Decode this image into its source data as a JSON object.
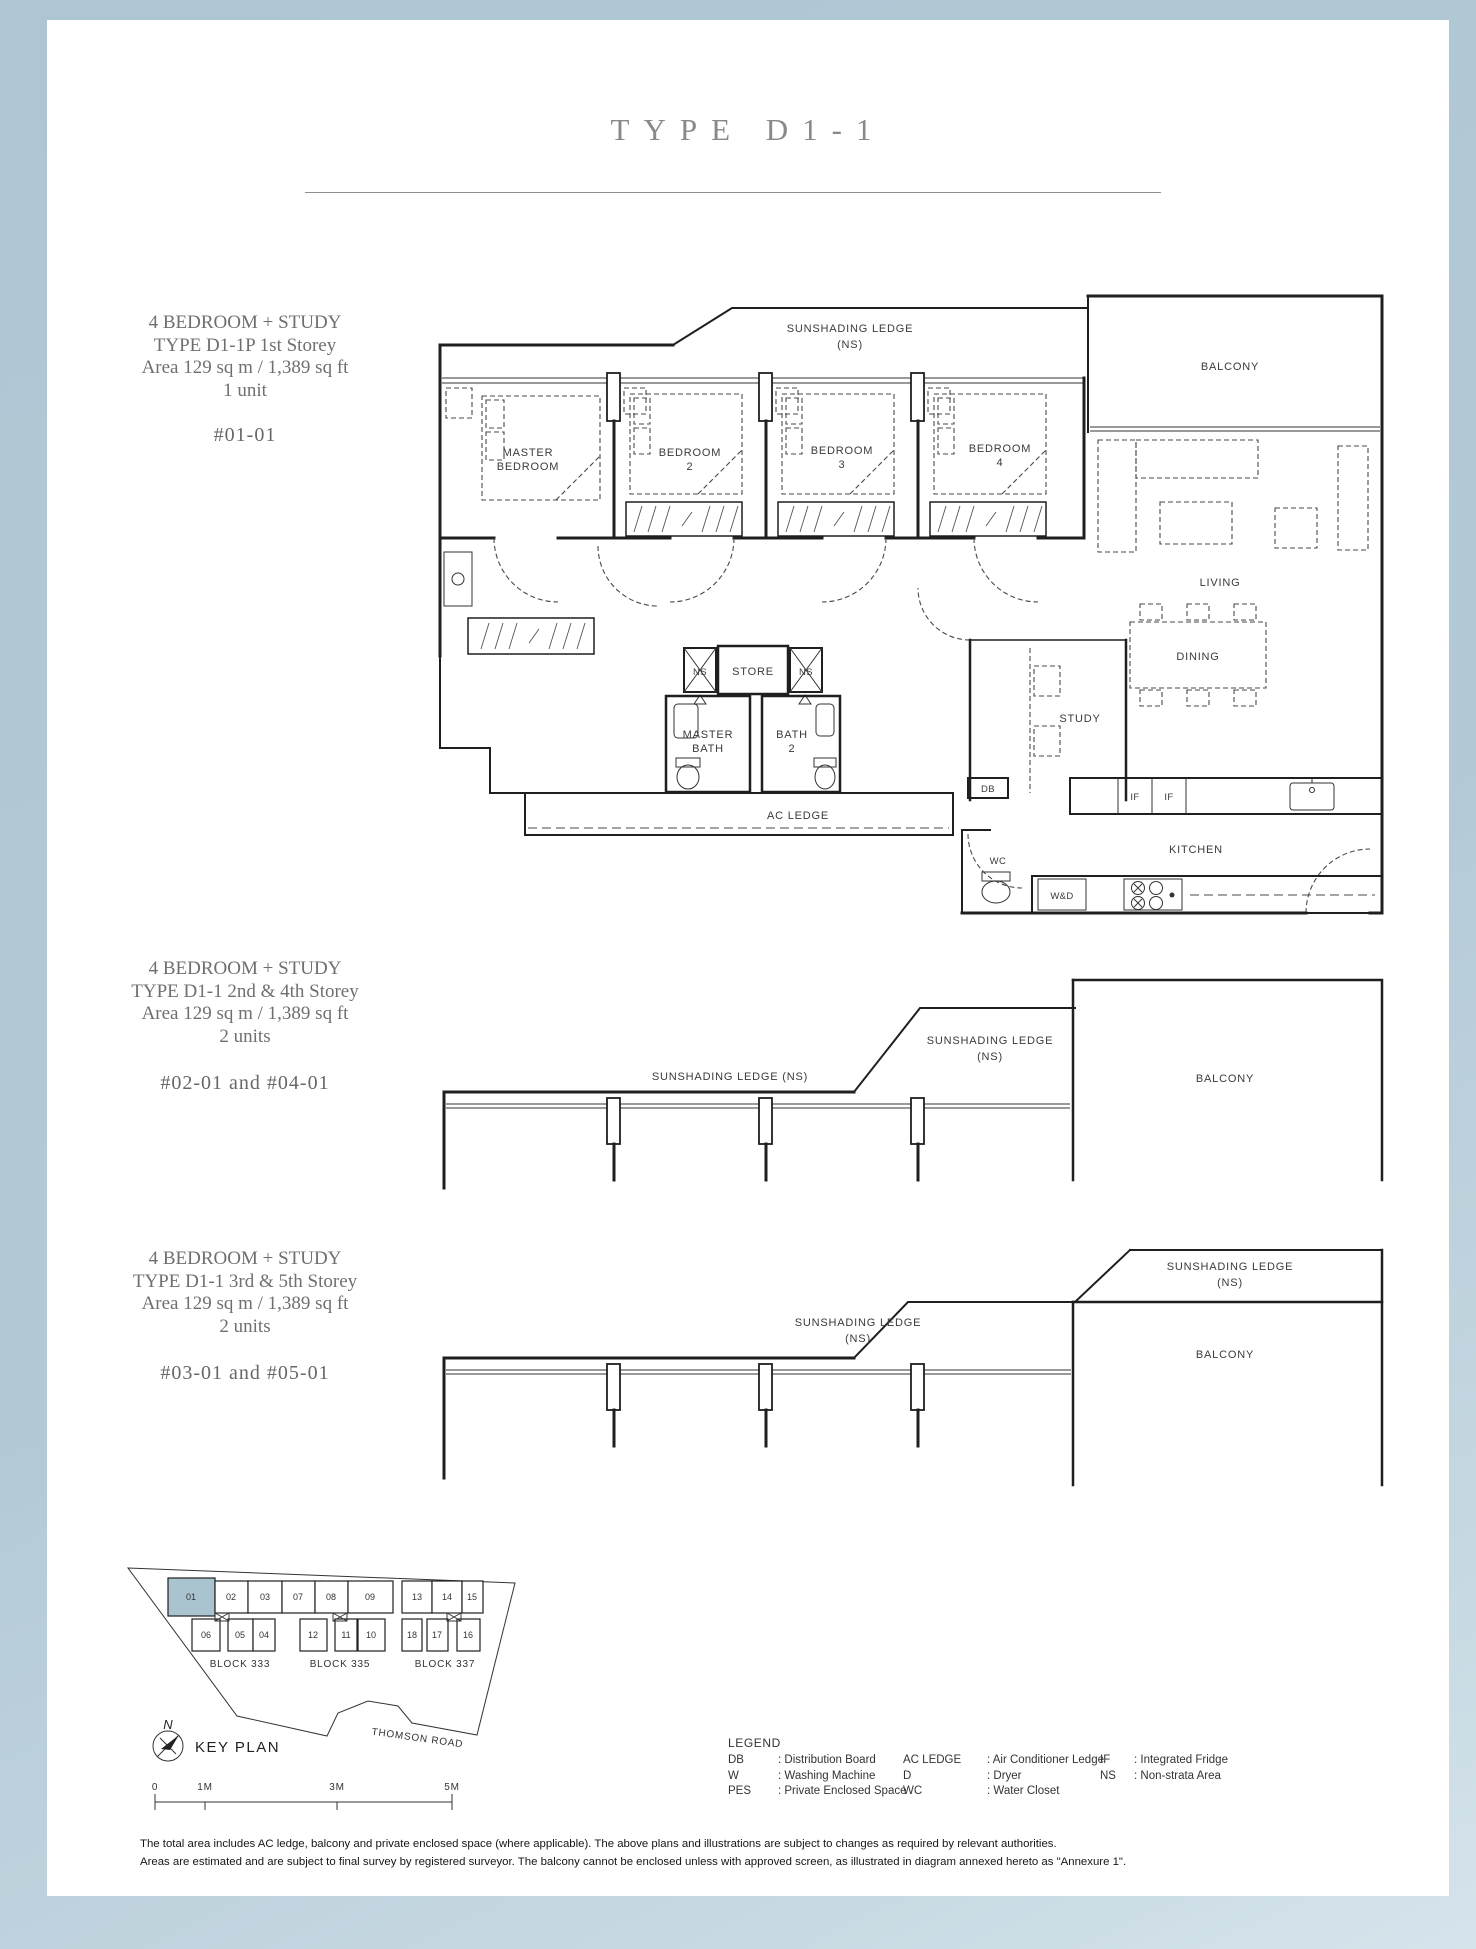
{
  "page": {
    "title": "TYPE D1-1",
    "disclaimer_line1": "The total area includes AC ledge, balcony and private enclosed space (where applicable). The above plans and illustrations are subject to changes as required by relevant authorities.",
    "disclaimer_line2": "Areas are estimated and are subject to final survey by registered surveyor. The balcony cannot be enclosed unless with approved screen, as illustrated in diagram annexed hereto as \"Annexure 1\"."
  },
  "sections": [
    {
      "line1": "4 BEDROOM + STUDY",
      "line2": "TYPE D1-1P 1st Storey",
      "line3": "Area 129 sq m / 1,389 sq ft",
      "line4": "1 unit",
      "units": "#01-01"
    },
    {
      "line1": "4 BEDROOM + STUDY",
      "line2": "TYPE D1-1 2nd & 4th Storey",
      "line3": "Area 129 sq m / 1,389 sq ft",
      "line4": "2 units",
      "units": "#02-01 and #04-01"
    },
    {
      "line1": "4 BEDROOM + STUDY",
      "line2": "TYPE D1-1 3rd & 5th Storey",
      "line3": "Area 129 sq m / 1,389 sq ft",
      "line4": "2 units",
      "units": "#03-01 and #05-01"
    }
  ],
  "plan": {
    "sunshading_line": "SUNSHADING LEDGE (NS)",
    "sunshading_l1": "SUNSHADING LEDGE",
    "sunshading_l2": "(NS)",
    "balcony": "BALCONY",
    "master": "MASTER",
    "bedroom": "BEDROOM",
    "num2": "2",
    "num3": "3",
    "num4": "4",
    "living": "LIVING",
    "dining": "DINING",
    "study": "STUDY",
    "store": "STORE",
    "ns": "NS",
    "bath": "BATH",
    "ac_ledge": "AC LEDGE",
    "kitchen": "KITCHEN",
    "db": "DB",
    "wc": "WC",
    "wd": "W&D",
    "if": "IF"
  },
  "keyplan": {
    "north": "N",
    "title": "KEY PLAN",
    "road": "THOMSON ROAD",
    "blocks": [
      "BLOCK 333",
      "BLOCK 335",
      "BLOCK 337"
    ],
    "row1": [
      "01",
      "02",
      "03",
      "07",
      "08",
      "09",
      "13",
      "14",
      "15"
    ],
    "row2": [
      "06",
      "05",
      "04",
      "12",
      "11",
      "10",
      "18",
      "17",
      "16"
    ],
    "highlighted_unit": "01",
    "highlight_color": "#a9c3cf",
    "scale": [
      "0",
      "1M",
      "3M",
      "5M"
    ]
  },
  "legend": {
    "title": "LEGEND",
    "col1": [
      {
        "abbr": "DB",
        "desc": ": Distribution Board"
      },
      {
        "abbr": "W",
        "desc": ": Washing Machine"
      },
      {
        "abbr": "PES",
        "desc": ": Private Enclosed Space"
      }
    ],
    "col2": [
      {
        "abbr": "AC LEDGE",
        "desc": ": Air Conditioner Ledge"
      },
      {
        "abbr": "D",
        "desc": ": Dryer"
      },
      {
        "abbr": "WC",
        "desc": ": Water Closet"
      }
    ],
    "col3": [
      {
        "abbr": "IF",
        "desc": ": Integrated Fridge"
      },
      {
        "abbr": "NS",
        "desc": ": Non-strata Area"
      }
    ]
  }
}
